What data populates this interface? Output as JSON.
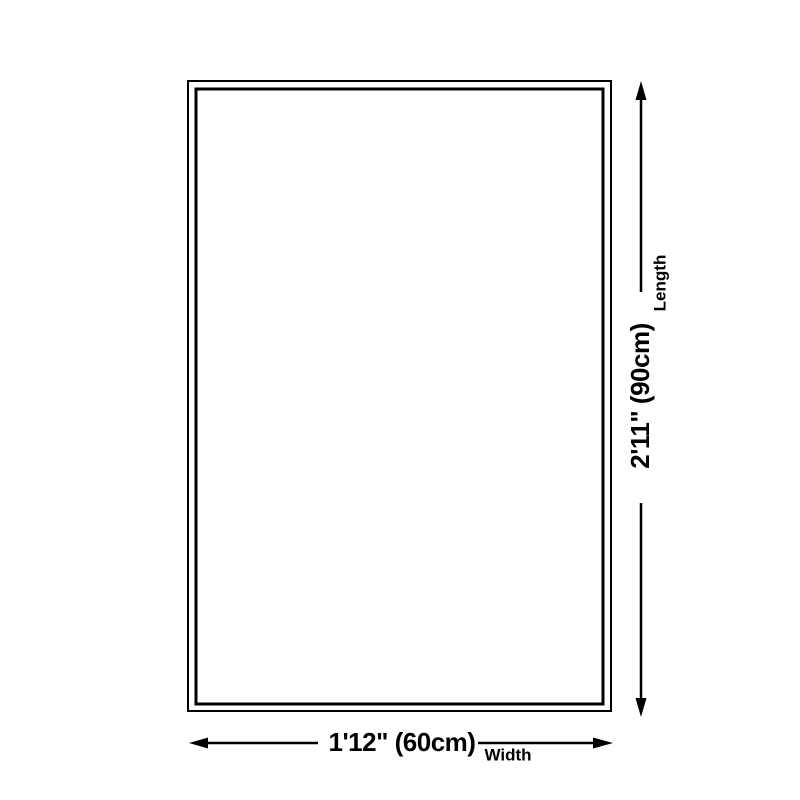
{
  "canvas": {
    "background_color": "#ffffff",
    "line_color": "#000000",
    "text_color": "#000000"
  },
  "diagram": {
    "type": "product-size-diagram",
    "length": {
      "value": "2'11\" (90cm)",
      "label": "Length"
    },
    "width": {
      "value": "1'12\" (60cm)",
      "label": "Width"
    }
  }
}
